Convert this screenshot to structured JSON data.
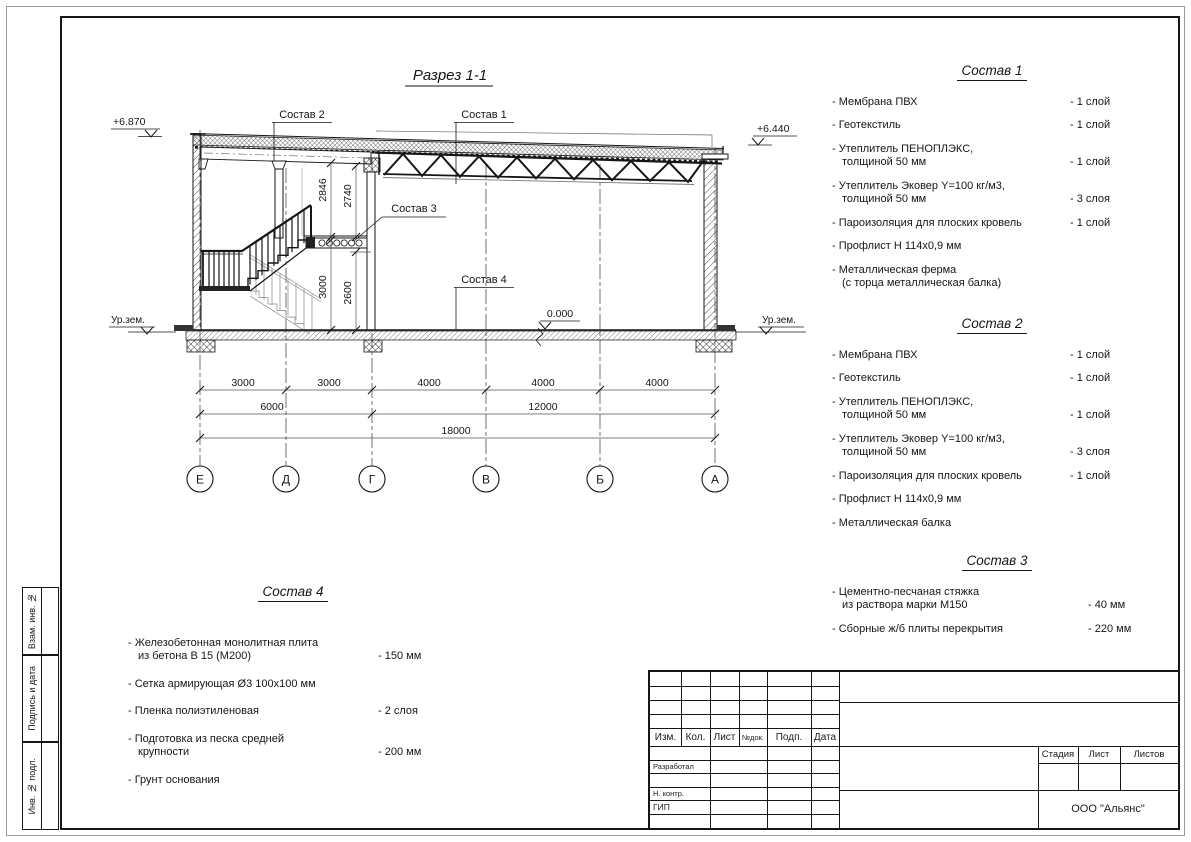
{
  "drawing": {
    "title": "Разрез 1-1",
    "elev_left": "+6.870",
    "elev_right": "+6.440",
    "ground_level_label": "Ур.зем.",
    "zero_level": "0.000",
    "callouts": [
      "Состав 2",
      "Состав 1",
      "Состав 3",
      "Состав 4"
    ],
    "vdims": [
      "2846",
      "2740",
      "3000",
      "2600"
    ],
    "dim_rows": {
      "row1": [
        "3000",
        "3000",
        "4000",
        "4000",
        "4000"
      ],
      "row2": [
        "6000",
        "12000"
      ],
      "row3": [
        "18000"
      ]
    },
    "axes": [
      "Е",
      "Д",
      "Г",
      "В",
      "Б",
      "А"
    ]
  },
  "lists": {
    "s1": {
      "title": "Состав 1",
      "items": [
        {
          "text": "- Мембрана ПВХ",
          "value": "- 1 слой"
        },
        {
          "text": "- Геотекстиль",
          "value": "- 1 слой"
        },
        {
          "text": "- Утеплитель ПЕНОПЛЭКС,\nтолщиной 50 мм",
          "value": "- 1 слой"
        },
        {
          "text": "- Утеплитель Эковер Y=100 кг/м3,\nтолщиной 50 мм",
          "value": "- 3 слоя"
        },
        {
          "text": "- Пароизоляция для плоских кровель",
          "value": "- 1 слой"
        },
        {
          "text": "- Профлист Н 114х0,9 мм",
          "value": ""
        },
        {
          "text": "- Металлическая ферма\n(с торца металлическая балка)",
          "value": ""
        }
      ]
    },
    "s2": {
      "title": "Состав 2",
      "items": [
        {
          "text": "- Мембрана ПВХ",
          "value": "- 1 слой"
        },
        {
          "text": "- Геотекстиль",
          "value": "- 1 слой"
        },
        {
          "text": "- Утеплитель ПЕНОПЛЭКС,\nтолщиной 50 мм",
          "value": "- 1 слой"
        },
        {
          "text": "- Утеплитель Эковер Y=100 кг/м3,\nтолщиной 50 мм",
          "value": "- 3 слоя"
        },
        {
          "text": "- Пароизоляция для плоских кровель",
          "value": "- 1 слой"
        },
        {
          "text": "- Профлист Н 114х0,9 мм",
          "value": ""
        },
        {
          "text": "- Металлическая балка",
          "value": ""
        }
      ]
    },
    "s3": {
      "title": "Состав 3",
      "items": [
        {
          "text": "- Цементно-песчаная стяжка\nиз раствора марки М150",
          "value": "- 40 мм"
        },
        {
          "text": "- Сборные ж/б плиты перекрытия",
          "value": "- 220 мм"
        }
      ]
    },
    "s4": {
      "title": "Состав 4",
      "items": [
        {
          "text": "- Железобетонная  монолитная плита\nиз бетона В 15 (М200)",
          "value": "- 150 мм"
        },
        {
          "text": "- Сетка армирующая Ø3 100х100 мм",
          "value": ""
        },
        {
          "text": "- Пленка полиэтиленовая",
          "value": "-  2 слоя"
        },
        {
          "text": "- Подготовка из песка средней\nкрупности",
          "value": "- 200 мм"
        },
        {
          "text": "- Грунт основания",
          "value": ""
        }
      ]
    }
  },
  "stamp": {
    "rev_header": [
      "Изм.",
      "Кол.",
      "Лист",
      "№док.",
      "Подп.",
      "Дата"
    ],
    "roles": [
      "Разработал",
      "Н. контр.",
      "ГИП"
    ],
    "stage_cols": [
      "Стадия",
      "Лист",
      "Листов"
    ],
    "org": "ООО \"Альянс\""
  },
  "side_labels": [
    "Взам. инв. №",
    "Подпись и дата",
    "Инв. № подл."
  ]
}
